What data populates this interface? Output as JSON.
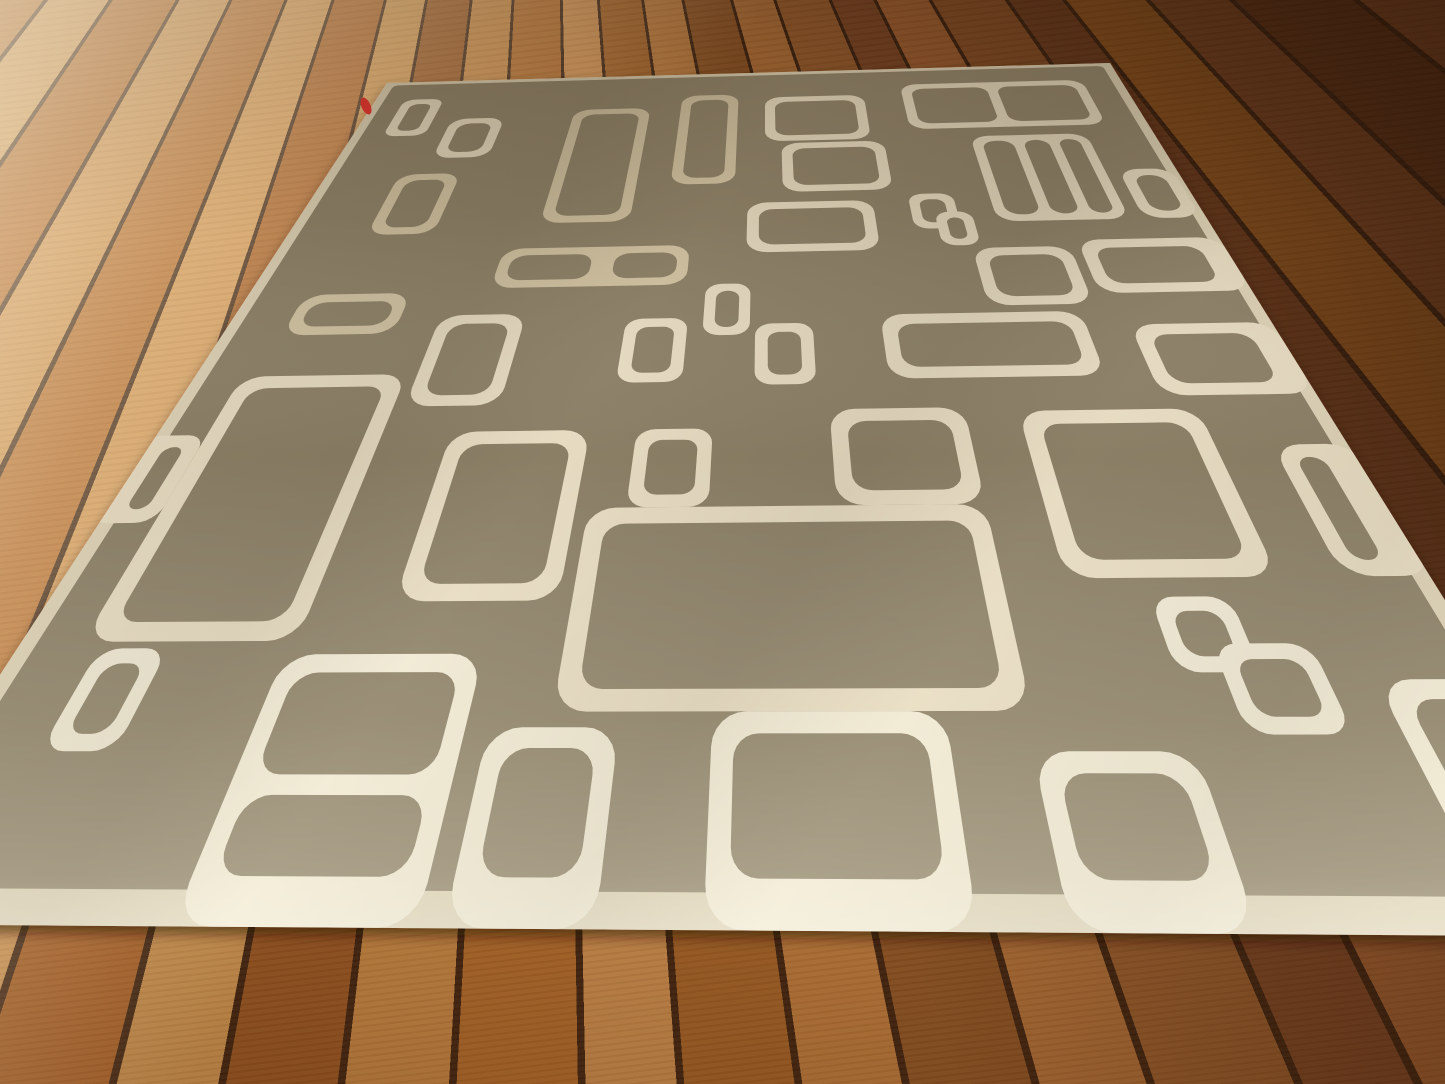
{
  "scene": {
    "kind": "photograph",
    "subject": "Taupe mid-century modern area rug with ivory rounded-rectangle pattern on acacia hardwood floor",
    "width": 1445,
    "height": 1084
  },
  "colors": {
    "rug_field": "#8b7f66",
    "pattern_cream": "#e7dcc2",
    "pattern_cream_dull": "#d2c4a3",
    "pattern_cream_bright": "#f0e9d4",
    "binding_cream": "#ddd2b6",
    "floor_seam": "#3c2210",
    "floor_light_plank": "#d09a58",
    "floor_dark_plank": "#5d3317",
    "tag_red": "#c03028",
    "shadow": "#2a1505"
  },
  "rug": {
    "quad": [
      [
        387,
        83
      ],
      [
        1110,
        63
      ],
      [
        1655,
        937
      ],
      [
        -163,
        924
      ]
    ],
    "field_inset": {
      "left": 1.2,
      "top": 0.8,
      "right": 1.2,
      "bottom": 1.8
    },
    "default_radius": 2.2,
    "default_hole_radius": 1.6,
    "tag": {
      "x": 366,
      "y": 106,
      "rx": 4.5,
      "ry": 9,
      "rot": -24
    },
    "shapes": [
      {
        "id": "corner-small-rect",
        "o": [
          4,
          5,
          5.5,
          9.5
        ],
        "holes": [
          [
            5.3,
            6.3,
            2.9,
            6.9
          ]
        ],
        "r": 1.6,
        "hr": 1.1
      },
      {
        "id": "far-small-rect",
        "o": [
          12,
          10.5,
          7,
          9.5
        ],
        "holes": [
          [
            13.3,
            11.8,
            4.4,
            6.9
          ]
        ]
      },
      {
        "id": "far-tall-rect-a",
        "o": [
          28,
          9,
          10,
          25
        ],
        "holes": [
          [
            29.3,
            10.3,
            7.4,
            22.4
          ]
        ],
        "tone": "dull"
      },
      {
        "id": "far-tall-rect-b",
        "o": [
          42,
          6,
          7.5,
          21
        ],
        "holes": [
          [
            43.3,
            7.3,
            4.9,
            18.4
          ]
        ],
        "tone": "dull"
      },
      {
        "id": "far-wide-rect",
        "o": [
          53,
          7,
          13,
          11
        ],
        "holes": [
          [
            54.3,
            8.3,
            10.4,
            8.4
          ]
        ]
      },
      {
        "id": "far-right-2cell",
        "o": [
          71,
          4.5,
          24,
          11.5
        ],
        "holes": [
          [
            72.3,
            5.8,
            9.9,
            8.9
          ],
          [
            83.5,
            5.8,
            10.2,
            8.9
          ]
        ]
      },
      {
        "id": "row2-rect",
        "o": [
          55,
          18.5,
          12.5,
          10.5
        ],
        "holes": [
          [
            56.3,
            19.8,
            9.9,
            7.9
          ]
        ]
      },
      {
        "id": "row2-3cell-window",
        "o": [
          78,
          18,
          14,
          17.5
        ],
        "holes": [
          [
            79.2,
            19.2,
            3.7,
            15.1
          ],
          [
            84.1,
            19.2,
            3.0,
            15.1
          ],
          [
            88.3,
            19.2,
            2.5,
            15.1
          ]
        ]
      },
      {
        "id": "link-square-top-a",
        "o": [
          69,
          30,
          5,
          6.5
        ],
        "holes": [
          [
            70.1,
            31.1,
            2.8,
            4.3
          ]
        ],
        "r": 1.6,
        "hr": 1.1
      },
      {
        "id": "link-square-top-b",
        "o": [
          71.5,
          33.5,
          4,
          6
        ],
        "holes": [
          [
            72.6,
            34.6,
            1.8,
            3.8
          ]
        ],
        "r": 1.6,
        "hr": 1.1
      },
      {
        "id": "row3-rect",
        "o": [
          51,
          31,
          14,
          9
        ],
        "holes": [
          [
            52.3,
            32.3,
            11.4,
            6.4
          ]
        ]
      },
      {
        "id": "left-square",
        "o": [
          9,
          23.5,
          7.5,
          12
        ],
        "holes": [
          [
            10.3,
            24.8,
            4.9,
            9.4
          ]
        ],
        "tone": "dull"
      },
      {
        "id": "edge-right-small",
        "o": [
          93.5,
          26,
          6,
          9.5
        ],
        "holes": [
          [
            94.8,
            27.3,
            3.4,
            6.9
          ]
        ]
      },
      {
        "id": "left-bar",
        "o": [
          6,
          45.5,
          11,
          6
        ],
        "holes": [
          [
            7.2,
            46.7,
            8.6,
            3.6
          ]
        ],
        "tone": "dull"
      },
      {
        "id": "mid-2cell-window",
        "o": [
          25,
          38.5,
          20,
          6.5
        ],
        "holes": [
          [
            26.2,
            39.7,
            8.6,
            4.1
          ],
          [
            37.2,
            39.7,
            6.6,
            4.1
          ]
        ],
        "tone": "dull"
      },
      {
        "id": "mid-small-sq-a",
        "o": [
          47,
          45,
          4.5,
          7.5
        ],
        "holes": [
          [
            48.1,
            46.1,
            2.3,
            5.3
          ]
        ],
        "r": 1.6,
        "hr": 1.1
      },
      {
        "id": "mid-small-sq-b",
        "o": [
          39.5,
          50,
          6,
          8.5
        ],
        "holes": [
          [
            40.7,
            51.2,
            3.6,
            6.1
          ]
        ],
        "r": 1.6,
        "hr": 1.1
      },
      {
        "id": "mid-small-sq-c",
        "o": [
          52,
          51,
          5.5,
          8
        ],
        "holes": [
          [
            53.2,
            52.2,
            3.1,
            5.6
          ]
        ],
        "r": 1.6,
        "hr": 1.1
      },
      {
        "id": "folder-rect",
        "o": [
          21,
          49,
          8.5,
          12
        ],
        "holes": [
          [
            22.3,
            50.3,
            5.9,
            9.4
          ]
        ]
      },
      {
        "id": "center-wide-bar",
        "o": [
          64,
          50,
          19,
          8.5
        ],
        "holes": [
          [
            65.4,
            51.4,
            16.2,
            5.7
          ]
        ]
      },
      {
        "id": "right-bar-upper",
        "o": [
          74.5,
          40,
          10,
          9
        ],
        "holes": [
          [
            75.8,
            41.3,
            7.4,
            6.4
          ]
        ]
      },
      {
        "id": "edge-right-bar-a",
        "o": [
          85.5,
          39,
          14.5,
          8.5
        ],
        "holes": [
          [
            86.9,
            40.4,
            10.6,
            5.7
          ]
        ]
      },
      {
        "id": "edge-right-bar-b",
        "o": [
          87,
          52,
          13,
          9
        ],
        "holes": [
          [
            88.4,
            53.4,
            9.1,
            6.2
          ]
        ]
      },
      {
        "id": "big-left-rect",
        "o": [
          4.5,
          57,
          15.5,
          26
        ],
        "holes": [
          [
            6,
            58.5,
            12.5,
            23
          ]
        ]
      },
      {
        "id": "center-tall-rect",
        "o": [
          26,
          64,
          12,
          16
        ],
        "holes": [
          [
            27.4,
            65.4,
            9.2,
            13.2
          ]
        ]
      },
      {
        "id": "center-small-sq",
        "o": [
          42,
          64,
          6.5,
          8
        ],
        "holes": [
          [
            43.2,
            65.2,
            4.1,
            5.6
          ]
        ],
        "r": 1.6,
        "hr": 1.1
      },
      {
        "id": "center-square",
        "o": [
          58.5,
          62,
          11.5,
          10
        ],
        "holes": [
          [
            59.9,
            63.4,
            8.7,
            7.2
          ]
        ]
      },
      {
        "id": "right-big-square",
        "o": [
          74.5,
          62.5,
          15,
          16
        ],
        "holes": [
          [
            76,
            64,
            12,
            13
          ]
        ]
      },
      {
        "id": "edge-right-rect",
        "o": [
          94,
          66.5,
          6.5,
          12
        ],
        "holes": [
          [
            95.3,
            67.8,
            2.2,
            9.4
          ]
        ]
      },
      {
        "id": "edge-left-nub",
        "o": [
          -1,
          64,
          5.5,
          9
        ],
        "holes": [
          [
            1.4,
            65.3,
            1.8,
            6.4
          ]
        ],
        "r": 1.6,
        "hr": 1.1
      },
      {
        "id": "near-left-diamond",
        "o": [
          6,
          83.5,
          5,
          7
        ],
        "holes": [
          [
            7.1,
            84.6,
            2.8,
            4.8
          ]
        ],
        "r": 1.6,
        "hr": 1.1,
        "tone": "bright"
      },
      {
        "id": "near-stacked-2cell",
        "o": [
          19.5,
          84,
          14,
          16
        ],
        "holes": [
          [
            20.8,
            85.3,
            11.4,
            6.6
          ],
          [
            20.8,
            93.1,
            11.4,
            4.4
          ]
        ],
        "tone": "bright"
      },
      {
        "id": "near-square-a",
        "o": [
          35,
          89,
          8.5,
          11
        ],
        "holes": [
          [
            36.3,
            90.3,
            5.9,
            7.2
          ]
        ],
        "tone": "bright"
      },
      {
        "id": "center-big-wide",
        "o": [
          39,
          72,
          31,
          16
        ],
        "holes": [
          [
            40.5,
            73.5,
            28,
            13
          ]
        ]
      },
      {
        "id": "near-square-b",
        "o": [
          49.5,
          88,
          15,
          12
        ],
        "holes": [
          [
            50.9,
            89.4,
            12.2,
            8.1
          ]
        ],
        "tone": "bright"
      },
      {
        "id": "near-square-c",
        "o": [
          69.5,
          90.5,
          10,
          9.5
        ],
        "holes": [
          [
            70.8,
            91.8,
            7.4,
            5.7
          ]
        ],
        "tone": "bright"
      },
      {
        "id": "link-square-bottom-a",
        "o": [
          80,
          80,
          5.5,
          5.5
        ],
        "holes": [
          [
            81.1,
            81.1,
            3.3,
            3.3
          ]
        ],
        "r": 1.6,
        "hr": 1.1,
        "tone": "bright"
      },
      {
        "id": "link-square-bottom-b",
        "o": [
          83,
          83.5,
          6.5,
          6
        ],
        "holes": [
          [
            84.1,
            84.6,
            4.3,
            3.8
          ]
        ],
        "r": 1.6,
        "hr": 1.1,
        "tone": "bright"
      },
      {
        "id": "near-right-partial",
        "o": [
          92.5,
          86,
          9,
          14
        ],
        "holes": [
          [
            93.8,
            87.3,
            6.4,
            10.2
          ]
        ],
        "tone": "bright"
      }
    ]
  }
}
